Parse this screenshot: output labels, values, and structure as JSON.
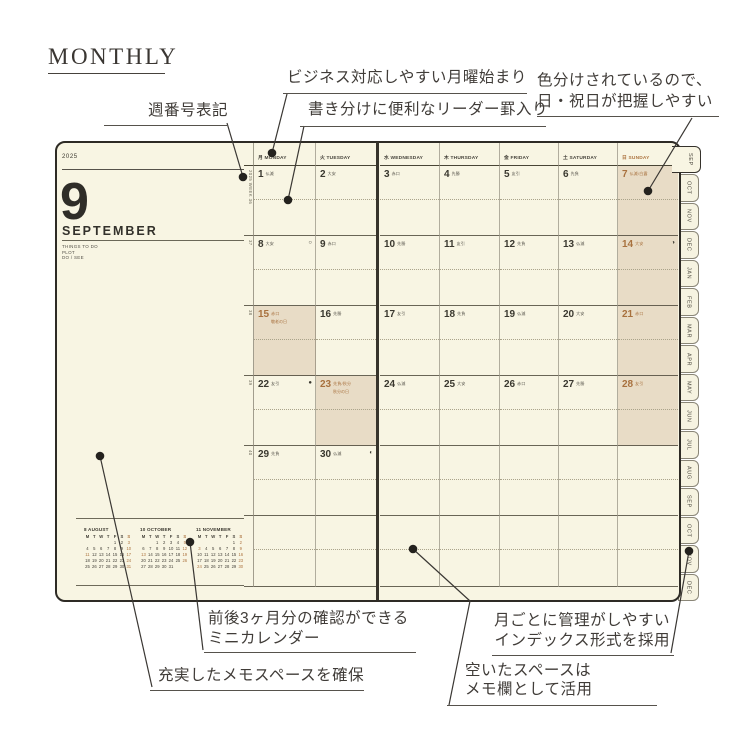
{
  "page": {
    "title": "MONTHLY"
  },
  "annotations": {
    "week_number": [
      "週番号表記"
    ],
    "monday_start": [
      "ビジネス対応しやすい月曜始まり"
    ],
    "leader_lines": [
      "書き分けに便利なリーダー罫入り"
    ],
    "color_coded": [
      "色分けされているので、",
      "日・祝日が把握しやすい"
    ],
    "mini_calendar": [
      "前後3ヶ月分の確認ができる",
      "ミニカレンダー"
    ],
    "memo_space": [
      "充実したメモスペースを確保"
    ],
    "index_tabs": [
      "月ごとに管理がしやすい",
      "インデックス形式を採用"
    ],
    "empty_space": [
      "空いたスペースは",
      "メモ欄として活用"
    ]
  },
  "planner": {
    "year": "2025",
    "month_number": "9",
    "month_name": "SEPTEMBER",
    "subtitle_lines": [
      "THINGS TO DO",
      "PLOT",
      "DO / SEE"
    ],
    "week_numbers": [
      "2025 WEEK 36",
      "37",
      "38",
      "39",
      "40",
      ""
    ],
    "day_headers": [
      {
        "jp": "月",
        "en": "MONDAY"
      },
      {
        "jp": "火",
        "en": "TUESDAY"
      },
      {
        "jp": "水",
        "en": "WEDNESDAY"
      },
      {
        "jp": "木",
        "en": "THURSDAY"
      },
      {
        "jp": "金",
        "en": "FRIDAY"
      },
      {
        "jp": "土",
        "en": "SATURDAY"
      },
      {
        "jp": "日",
        "en": "SUNDAY",
        "accent": true
      }
    ],
    "weeks": [
      [
        {
          "d": "1",
          "r": "仏滅"
        },
        {
          "d": "2",
          "r": "大安"
        },
        {
          "d": "3",
          "r": "赤口"
        },
        {
          "d": "4",
          "r": "先勝"
        },
        {
          "d": "5",
          "r": "友引"
        },
        {
          "d": "6",
          "r": "先負"
        },
        {
          "d": "7",
          "r": "仏滅/白露",
          "shaded": true,
          "accent": true
        }
      ],
      [
        {
          "d": "8",
          "r": "大安",
          "moon": "○"
        },
        {
          "d": "9",
          "r": "赤口"
        },
        {
          "d": "10",
          "r": "先勝"
        },
        {
          "d": "11",
          "r": "友引"
        },
        {
          "d": "12",
          "r": "先負"
        },
        {
          "d": "13",
          "r": "仏滅"
        },
        {
          "d": "14",
          "r": "大安",
          "moon": "◑",
          "shaded": true,
          "accent": true
        }
      ],
      [
        {
          "d": "15",
          "r": "赤口",
          "h": "敬老の日",
          "shaded": true,
          "accent": true
        },
        {
          "d": "16",
          "r": "先勝"
        },
        {
          "d": "17",
          "r": "友引"
        },
        {
          "d": "18",
          "r": "先負"
        },
        {
          "d": "19",
          "r": "仏滅"
        },
        {
          "d": "20",
          "r": "大安"
        },
        {
          "d": "21",
          "r": "赤口",
          "shaded": true,
          "accent": true
        }
      ],
      [
        {
          "d": "22",
          "r": "友引",
          "moon": "●"
        },
        {
          "d": "23",
          "r": "先負/秋分",
          "h": "秋分の日",
          "shaded": true,
          "accent": true
        },
        {
          "d": "24",
          "r": "仏滅"
        },
        {
          "d": "25",
          "r": "大安"
        },
        {
          "d": "26",
          "r": "赤口"
        },
        {
          "d": "27",
          "r": "先勝"
        },
        {
          "d": "28",
          "r": "友引",
          "shaded": true,
          "accent": true
        }
      ],
      [
        {
          "d": "29",
          "r": "先負"
        },
        {
          "d": "30",
          "r": "仏滅",
          "moon": "◐"
        },
        {},
        {},
        {},
        {},
        {}
      ],
      [
        {},
        {},
        {},
        {},
        {},
        {},
        {}
      ]
    ],
    "mini_calendars": [
      {
        "title": "8 AUGUST",
        "header": [
          "M",
          "T",
          "W",
          "T",
          "F",
          "S",
          "S"
        ],
        "weeks": [
          [
            "",
            "",
            "",
            "",
            "1",
            "2",
            "3"
          ],
          [
            "4",
            "5",
            "6",
            "7",
            "8",
            "9",
            "10"
          ],
          [
            "11",
            "12",
            "13",
            "14",
            "15",
            "16",
            "17"
          ],
          [
            "18",
            "19",
            "20",
            "21",
            "22",
            "23",
            "24"
          ],
          [
            "25",
            "26",
            "27",
            "28",
            "29",
            "30",
            "31"
          ]
        ],
        "accent_days": [
          "3",
          "10",
          "17",
          "24",
          "31",
          "11"
        ]
      },
      {
        "title": "10 OCTOBER",
        "header": [
          "M",
          "T",
          "W",
          "T",
          "F",
          "S",
          "S"
        ],
        "weeks": [
          [
            "",
            "",
            "1",
            "2",
            "3",
            "4",
            "5"
          ],
          [
            "6",
            "7",
            "8",
            "9",
            "10",
            "11",
            "12"
          ],
          [
            "13",
            "14",
            "15",
            "16",
            "17",
            "18",
            "19"
          ],
          [
            "20",
            "21",
            "22",
            "23",
            "24",
            "25",
            "26"
          ],
          [
            "27",
            "28",
            "29",
            "30",
            "31",
            "",
            ""
          ]
        ],
        "accent_days": [
          "5",
          "12",
          "19",
          "26",
          "13"
        ]
      },
      {
        "title": "11 NOVEMBER",
        "header": [
          "M",
          "T",
          "W",
          "T",
          "F",
          "S",
          "S"
        ],
        "weeks": [
          [
            "",
            "",
            "",
            "",
            "",
            "1",
            "2"
          ],
          [
            "3",
            "4",
            "5",
            "6",
            "7",
            "8",
            "9"
          ],
          [
            "10",
            "11",
            "12",
            "13",
            "14",
            "15",
            "16"
          ],
          [
            "17",
            "18",
            "19",
            "20",
            "21",
            "22",
            "23"
          ],
          [
            "24",
            "25",
            "26",
            "27",
            "28",
            "29",
            "30"
          ]
        ],
        "accent_days": [
          "2",
          "9",
          "16",
          "23",
          "30",
          "3",
          "24"
        ]
      }
    ],
    "tabs": [
      "SEP",
      "OCT",
      "NOV",
      "DEC",
      "JAN",
      "FEB",
      "MAR",
      "APR",
      "MAY",
      "JUN",
      "JUL",
      "AUG",
      "SEP",
      "OCT",
      "NOV",
      "DEC"
    ],
    "colors": {
      "page": "#f8f5e3",
      "shade": "#e8dcc6",
      "accent": "#ad7440",
      "ink": "#3a382f",
      "cover": "#2e2b25"
    }
  }
}
